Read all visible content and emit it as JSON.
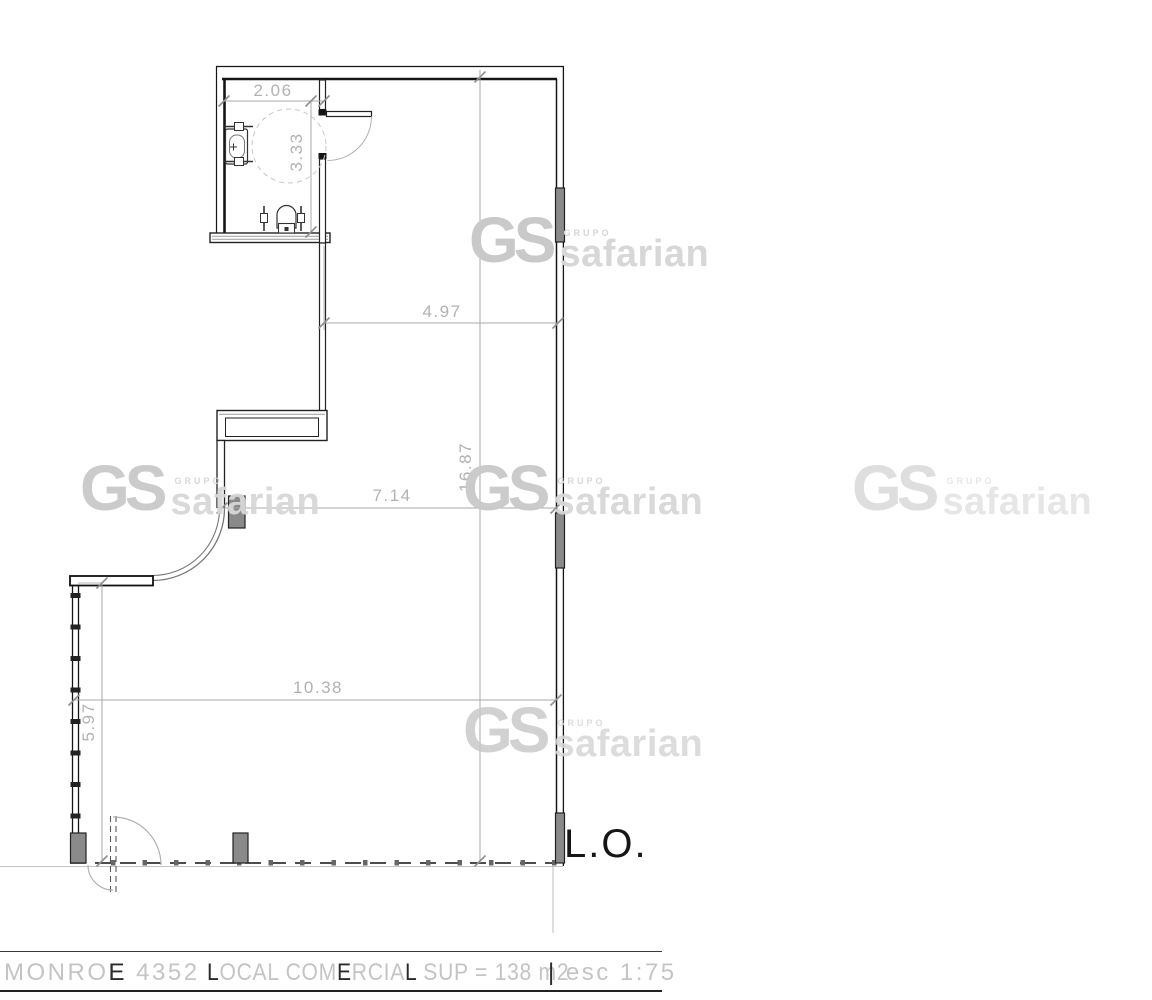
{
  "plan": {
    "dimensions": {
      "bathroom_width": "2.06",
      "bathroom_height": "3.33",
      "upper_width": "4.97",
      "total_depth": "16.87",
      "mid_width": "7.14",
      "lower_width": "10.38",
      "left_front_height": "5.97"
    },
    "labels": {
      "property_line": "L.O."
    }
  },
  "watermark": {
    "gs": "GS",
    "grupo": "GRUPO",
    "name": "safarian"
  },
  "title_block": {
    "address": "MONROE 4352",
    "description": "LOCAL COMERCIAL SUP = 138 m2",
    "scale": "esc 1:75",
    "left_segments": [
      {
        "t": "MONRO",
        "d": 0
      },
      {
        "t": "E",
        "d": 1
      },
      {
        "t": " 4352",
        "d": 0
      }
    ],
    "center_segments": [
      {
        "t": "L",
        "d": 1
      },
      {
        "t": "OCAL COM",
        "d": 0
      },
      {
        "t": "E",
        "d": 1
      },
      {
        "t": "RCIA",
        "d": 0
      },
      {
        "t": "L",
        "d": 1
      },
      {
        "t": " SUP = 138 m2",
        "d": 0
      }
    ],
    "right_segments": [
      {
        "t": "|",
        "d": 1
      },
      {
        "t": " esc 1:75",
        "d": 0
      }
    ]
  },
  "colors": {
    "wall": "#151515",
    "column_fill": "#8a8a8a",
    "dimension_line": "#a8a8a8",
    "dimension_text": "#b2b2b2",
    "watermark_gs": "#c9c9c9",
    "watermark_text": "#d7d7d7"
  }
}
